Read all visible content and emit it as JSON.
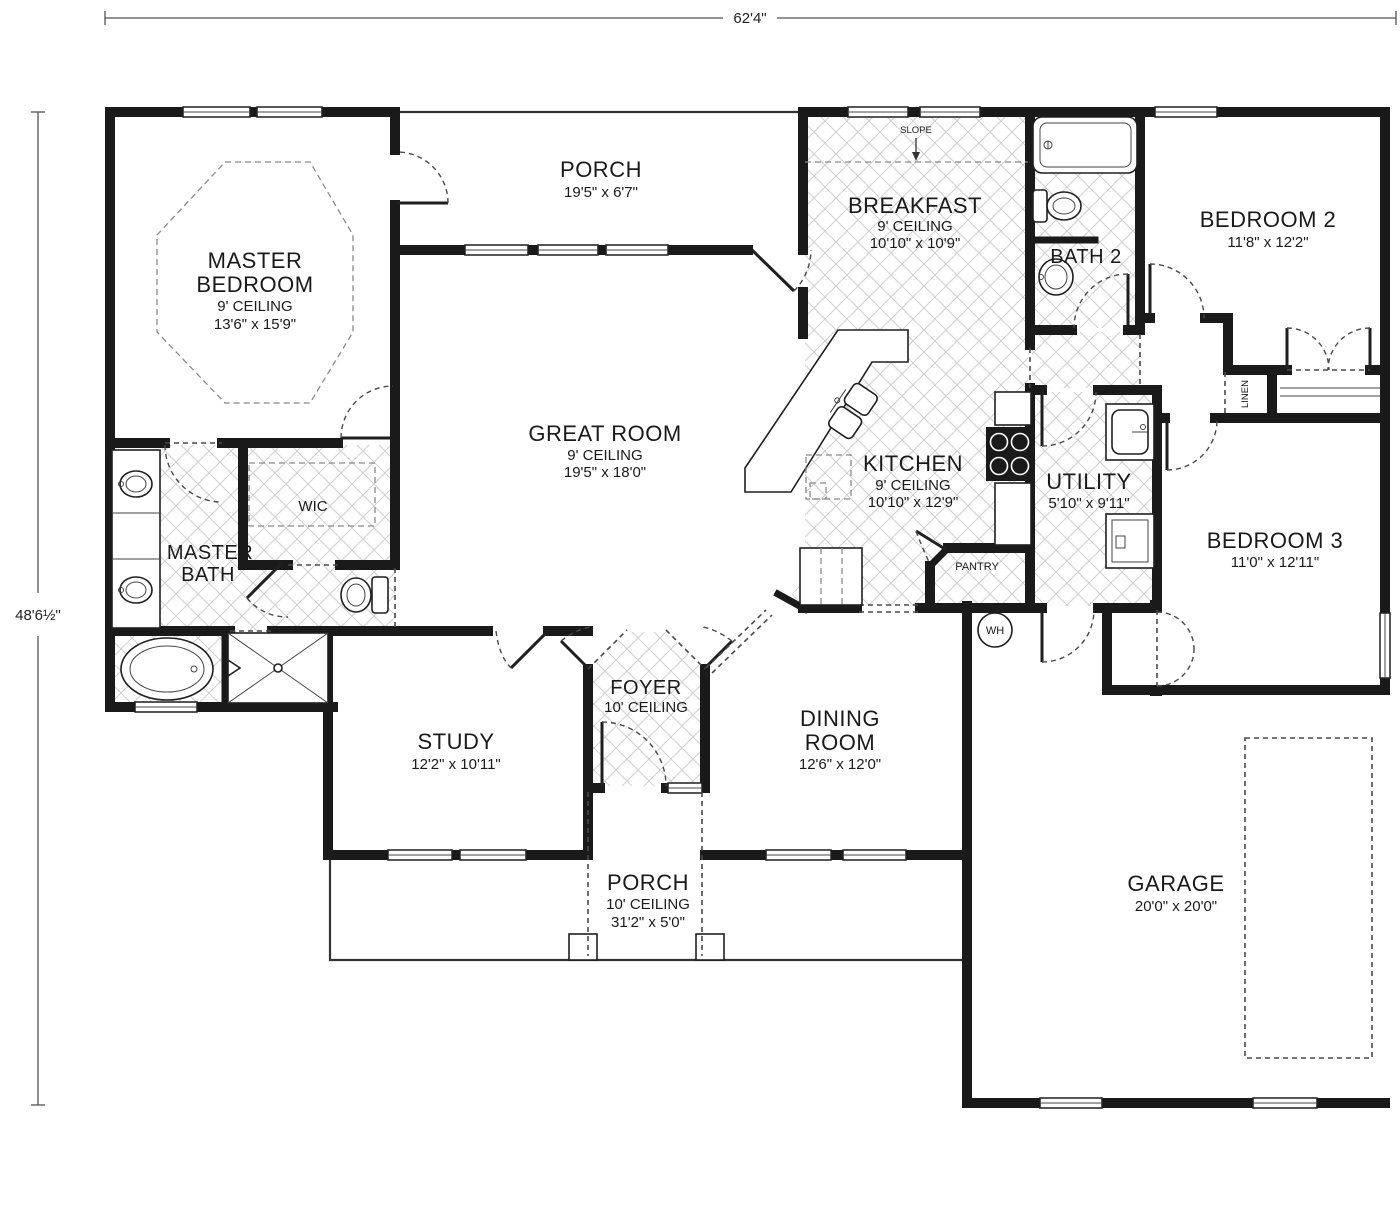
{
  "dimensions": {
    "overall_width": "62'4\"",
    "overall_height": "48'6½\""
  },
  "rooms": {
    "master_bedroom": {
      "line1": "MASTER",
      "line2": "BEDROOM",
      "ceiling": "9' CEILING",
      "size": "13'6\" x 15'9\""
    },
    "rear_porch": {
      "line1": "PORCH",
      "size": "19'5\" x 6'7\""
    },
    "breakfast": {
      "line1": "BREAKFAST",
      "ceiling": "9' CEILING",
      "size": "10'10\" x 10'9\""
    },
    "bath2": {
      "line1": "BATH 2"
    },
    "bedroom2": {
      "line1": "BEDROOM 2",
      "size": "11'8\" x 12'2\""
    },
    "great_room": {
      "line1": "GREAT ROOM",
      "ceiling": "9' CEILING",
      "size": "19'5\" x 18'0\""
    },
    "kitchen": {
      "line1": "KITCHEN",
      "ceiling": "9' CEILING",
      "size": "10'10\" x 12'9\""
    },
    "utility": {
      "line1": "UTILITY",
      "size": "5'10\" x 9'11\""
    },
    "bedroom3": {
      "line1": "BEDROOM 3",
      "size": "11'0\" x 12'11\""
    },
    "master_bath": {
      "line1": "MASTER",
      "line2": "BATH"
    },
    "wic": {
      "line1": "WIC"
    },
    "study": {
      "line1": "STUDY",
      "size": "12'2\" x 10'11\""
    },
    "foyer": {
      "line1": "FOYER",
      "ceiling": "10' CEILING"
    },
    "dining": {
      "line1": "DINING",
      "line2": "ROOM",
      "size": "12'6\" x 12'0\""
    },
    "front_porch": {
      "line1": "PORCH",
      "ceiling": "10' CEILING",
      "size": "31'2\" x 5'0\""
    },
    "garage": {
      "line1": "GARAGE",
      "size": "20'0\" x 20'0\""
    },
    "pantry": {
      "line1": "PANTRY"
    },
    "linen": {
      "line1": "LINEN"
    },
    "water_heater": {
      "line1": "WH"
    },
    "slope": {
      "line1": "SLOPE"
    }
  }
}
